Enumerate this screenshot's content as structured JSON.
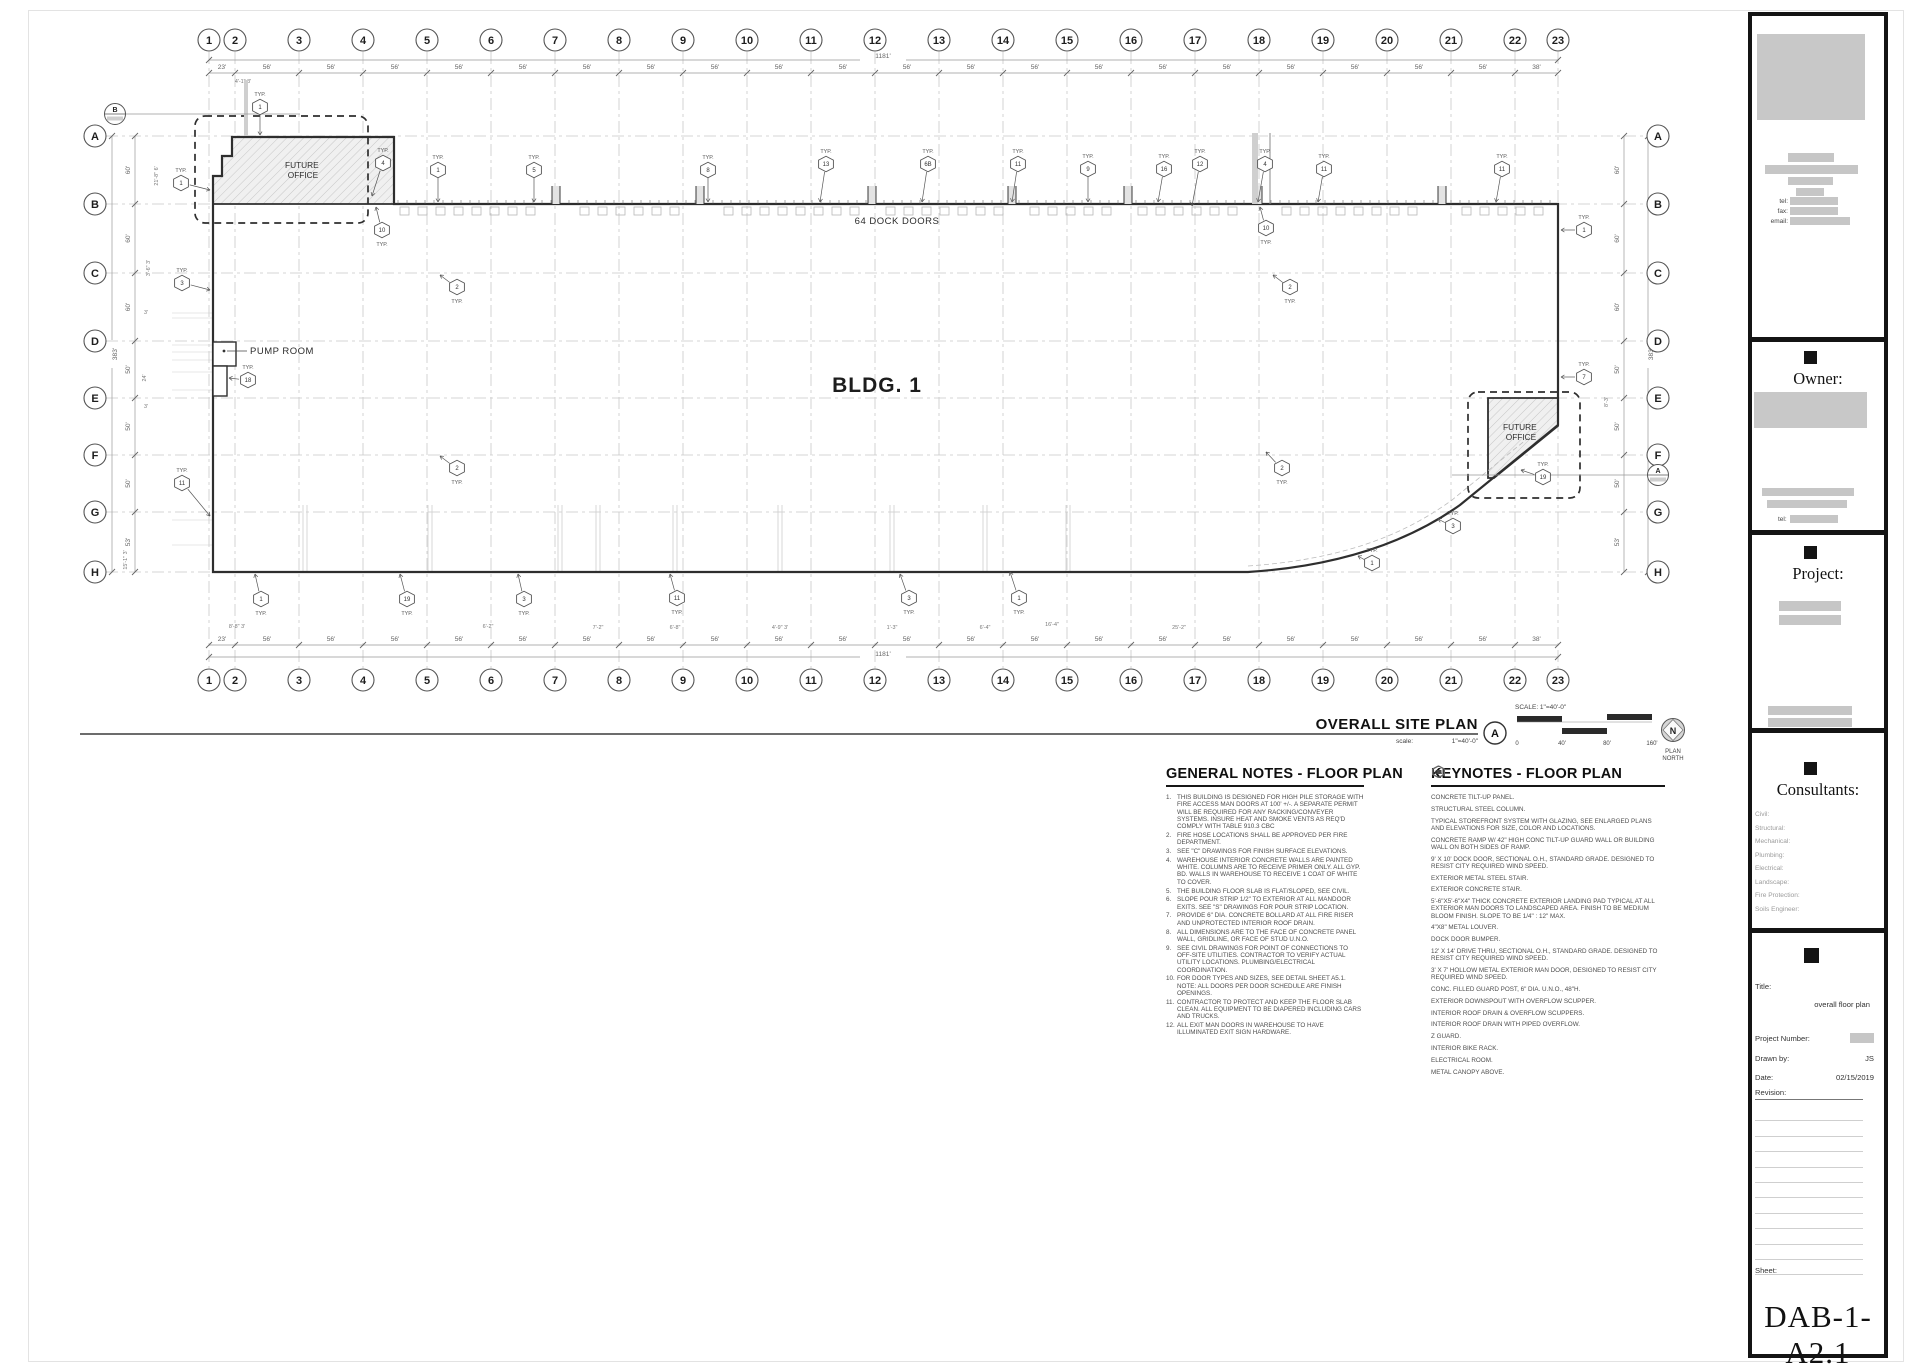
{
  "colors": {
    "wall": "#2e2e2e",
    "centerline": "#c9c9c9",
    "dim": "#999999",
    "redact": "#c6c6c6"
  },
  "plan": {
    "building_label": "BLDG. 1",
    "dock_label": "64 DOCK DOORS",
    "pump_label": "PUMP ROOM",
    "future_office_line1": "FUTURE",
    "future_office_line2": "OFFICE",
    "grid_cols": [
      "1",
      "2",
      "3",
      "4",
      "5",
      "6",
      "7",
      "8",
      "9",
      "10",
      "11",
      "12",
      "13",
      "14",
      "15",
      "16",
      "17",
      "18",
      "19",
      "20",
      "21",
      "22",
      "23"
    ],
    "grid_rows": [
      "A",
      "B",
      "C",
      "D",
      "E",
      "F",
      "G",
      "H"
    ],
    "bay_dims": [
      "23'",
      "56'",
      "56'",
      "56'",
      "56'",
      "56'",
      "56'",
      "56'",
      "56'",
      "56'",
      "56'",
      "56'",
      "56'",
      "56'",
      "56'",
      "56'",
      "56'",
      "56'",
      "56'",
      "56'",
      "56'",
      "38'"
    ],
    "overall_dim": "1181'",
    "side_dims": [
      "60'",
      "60'",
      "60'",
      "50'",
      "50'",
      "50'",
      "53'"
    ],
    "overall_side_dim": "383'",
    "typ_label": "TYP.",
    "ref_markers": [
      {
        "letter": "B",
        "x": 115,
        "y": 114,
        "lx": 300
      },
      {
        "letter": "A",
        "x": 1658,
        "y": 475,
        "lx": 1452
      }
    ],
    "small_dims": [
      {
        "t": "4'-1\" 3'",
        "x": 243,
        "y": 83,
        "rot": false
      },
      {
        "t": "21'-8\" 6'",
        "x": 158,
        "y": 176,
        "rot": true
      },
      {
        "t": "3'-6\" 3'",
        "x": 150,
        "y": 268,
        "rot": true
      },
      {
        "t": "3'",
        "x": 146,
        "y": 314,
        "rot": false
      },
      {
        "t": "24'",
        "x": 146,
        "y": 378,
        "rot": true
      },
      {
        "t": "3'",
        "x": 146,
        "y": 408,
        "rot": false
      },
      {
        "t": "15'-1\" 3'",
        "x": 127,
        "y": 560,
        "rot": true
      },
      {
        "t": "8'-3'",
        "x": 1608,
        "y": 402,
        "rot": true
      },
      {
        "t": "8'-8\" 3'",
        "x": 237,
        "y": 628,
        "rot": false
      },
      {
        "t": "6'-2\"",
        "x": 488,
        "y": 628,
        "rot": false
      },
      {
        "t": "7'-2\"",
        "x": 598,
        "y": 629,
        "rot": false
      },
      {
        "t": "6'-8\"",
        "x": 675,
        "y": 629,
        "rot": false
      },
      {
        "t": "4'-9\" 3'",
        "x": 780,
        "y": 629,
        "rot": false
      },
      {
        "t": "1'-3\"",
        "x": 892,
        "y": 629,
        "rot": false
      },
      {
        "t": "6'-4\"",
        "x": 985,
        "y": 629,
        "rot": false
      },
      {
        "t": "16'-4\"",
        "x": 1052,
        "y": 626,
        "rot": false
      },
      {
        "t": "25'-2\"",
        "x": 1179,
        "y": 629,
        "rot": false
      }
    ],
    "tags": [
      {
        "n": "1",
        "x": 438,
        "y": 170,
        "p": "a",
        "tx": 438,
        "ty": 202
      },
      {
        "n": "5",
        "x": 534,
        "y": 170,
        "p": "a",
        "tx": 534,
        "ty": 202
      },
      {
        "n": "8",
        "x": 708,
        "y": 170,
        "p": "a",
        "tx": 708,
        "ty": 202
      },
      {
        "n": "13",
        "x": 826,
        "y": 164,
        "p": "a",
        "tx": 820,
        "ty": 202
      },
      {
        "n": "6B",
        "x": 928,
        "y": 164,
        "p": "a",
        "tx": 922,
        "ty": 202
      },
      {
        "n": "11",
        "x": 1018,
        "y": 164,
        "p": "a",
        "tx": 1012,
        "ty": 202
      },
      {
        "n": "9",
        "x": 1088,
        "y": 169,
        "p": "a",
        "tx": 1088,
        "ty": 202
      },
      {
        "n": "16",
        "x": 1164,
        "y": 169,
        "p": "a",
        "tx": 1158,
        "ty": 202
      },
      {
        "n": "12",
        "x": 1200,
        "y": 164,
        "p": "a",
        "tx": 1192,
        "ty": 206
      },
      {
        "n": "4",
        "x": 1265,
        "y": 164,
        "p": "a",
        "tx": 1258,
        "ty": 202
      },
      {
        "n": "11",
        "x": 1324,
        "y": 169,
        "p": "a",
        "tx": 1318,
        "ty": 202
      },
      {
        "n": "11",
        "x": 1502,
        "y": 169,
        "p": "a",
        "tx": 1496,
        "ty": 202
      },
      {
        "n": "1",
        "x": 260,
        "y": 107,
        "p": "a",
        "tx": 260,
        "ty": 135
      },
      {
        "n": "4",
        "x": 383,
        "y": 163,
        "p": "a",
        "tx": 372,
        "ty": 196
      },
      {
        "n": "1",
        "x": 181,
        "y": 183,
        "p": "a",
        "tx": 210,
        "ty": 190
      },
      {
        "n": "3",
        "x": 182,
        "y": 283,
        "p": "a",
        "tx": 210,
        "ty": 290
      },
      {
        "n": "18",
        "x": 248,
        "y": 380,
        "p": "a",
        "tx": 229,
        "ty": 378
      },
      {
        "n": "11",
        "x": 182,
        "y": 483,
        "p": "a",
        "tx": 210,
        "ty": 516
      },
      {
        "n": "10",
        "x": 382,
        "y": 230,
        "p": "b",
        "tx": 376,
        "ty": 207
      },
      {
        "n": "10",
        "x": 1266,
        "y": 228,
        "p": "b",
        "tx": 1260,
        "ty": 207
      },
      {
        "n": "2",
        "x": 457,
        "y": 287,
        "p": "b",
        "tx": 440,
        "ty": 275
      },
      {
        "n": "2",
        "x": 1290,
        "y": 287,
        "p": "b",
        "tx": 1273,
        "ty": 275
      },
      {
        "n": "2",
        "x": 457,
        "y": 468,
        "p": "b",
        "tx": 440,
        "ty": 456
      },
      {
        "n": "2",
        "x": 1282,
        "y": 468,
        "p": "b",
        "tx": 1266,
        "ty": 452
      },
      {
        "n": "1",
        "x": 1584,
        "y": 230,
        "p": "a",
        "tx": 1561,
        "ty": 230
      },
      {
        "n": "7",
        "x": 1584,
        "y": 377,
        "p": "a",
        "tx": 1561,
        "ty": 377
      },
      {
        "n": "1",
        "x": 261,
        "y": 599,
        "p": "b",
        "tx": 255,
        "ty": 574
      },
      {
        "n": "19",
        "x": 407,
        "y": 599,
        "p": "b",
        "tx": 400,
        "ty": 574
      },
      {
        "n": "3",
        "x": 524,
        "y": 599,
        "p": "b",
        "tx": 518,
        "ty": 574
      },
      {
        "n": "11",
        "x": 677,
        "y": 598,
        "p": "b",
        "tx": 670,
        "ty": 574
      },
      {
        "n": "3",
        "x": 909,
        "y": 598,
        "p": "b",
        "tx": 900,
        "ty": 574
      },
      {
        "n": "1",
        "x": 1019,
        "y": 598,
        "p": "b",
        "tx": 1010,
        "ty": 572
      },
      {
        "n": "1",
        "x": 1372,
        "y": 563,
        "p": "a",
        "tx": 1358,
        "ty": 556
      },
      {
        "n": "3",
        "x": 1453,
        "y": 526,
        "p": "a",
        "tx": 1438,
        "ty": 519
      },
      {
        "n": "19",
        "x": 1543,
        "y": 477,
        "p": "a",
        "tx": 1521,
        "ty": 470
      }
    ]
  },
  "view_title": {
    "label": "OVERALL SITE PLAN",
    "scale_label": "scale:",
    "scale_value": "1\"=40'-0\"",
    "bubble": "A",
    "scalebar_label": "SCALE: 1\"=40'-0\"",
    "scalebar_ticks": [
      "0",
      "40'",
      "80'",
      "160'"
    ],
    "north_letter": "N",
    "north_caption_line1": "PLAN",
    "north_caption_line2": "NORTH"
  },
  "general_notes": {
    "title": "GENERAL NOTES - FLOOR PLAN",
    "items": [
      "THIS BUILDING IS DESIGNED FOR HIGH PILE STORAGE WITH FIRE ACCESS MAN DOORS AT 100' +/-. A SEPARATE PERMIT WILL BE REQUIRED FOR ANY RACKING/CONVEYER SYSTEMS. INSURE HEAT AND SMOKE VENTS AS REQ'D COMPLY WITH TABLE 910.3 CBC",
      "FIRE HOSE LOCATIONS SHALL BE APPROVED PER FIRE DEPARTMENT.",
      "SEE \"C\" DRAWINGS FOR FINISH SURFACE ELEVATIONS.",
      "WAREHOUSE INTERIOR CONCRETE WALLS ARE PAINTED WHITE. COLUMNS ARE TO RECEIVE PRIMER ONLY. ALL GYP. BD. WALLS IN WAREHOUSE TO RECEIVE 1 COAT OF WHITE TO COVER.",
      "THE BUILDING FLOOR SLAB IS FLAT/SLOPED, SEE CIVIL.",
      "SLOPE POUR STRIP 1/2\" TO EXTERIOR AT ALL MANDOOR EXITS. SEE \"S\" DRAWINGS FOR POUR STRIP LOCATION.",
      "PROVIDE 6\" DIA. CONCRETE BOLLARD AT ALL FIRE RISER AND UNPROTECTED INTERIOR ROOF DRAIN.",
      "ALL DIMENSIONS ARE TO THE FACE OF CONCRETE PANEL WALL, GRIDLINE, OR FACE OF STUD U.N.O.",
      "SEE CIVIL DRAWINGS FOR POINT OF CONNECTIONS TO OFF-SITE UTILITIES. CONTRACTOR TO VERIFY ACTUAL UTILITY LOCATIONS. PLUMBING/ELECTRICAL COORDINATION.",
      "FOR DOOR TYPES AND SIZES, SEE DETAIL SHEET A5.1. NOTE: ALL DOORS PER DOOR SCHEDULE ARE FINISH OPENINGS.",
      "CONTRACTOR TO PROTECT AND KEEP THE FLOOR SLAB CLEAN. ALL EQUIPMENT TO BE DIAPERED INCLUDING CARS AND TRUCKS.",
      "ALL EXIT MAN DOORS IN WAREHOUSE TO HAVE ILLUMINATED EXIT SIGN HARDWARE."
    ]
  },
  "keynotes": {
    "title": "KEYNOTES - FLOOR PLAN",
    "items": [
      {
        "n": "1",
        "text": "CONCRETE TILT-UP PANEL."
      },
      {
        "n": "2",
        "text": "STRUCTURAL STEEL COLUMN."
      },
      {
        "n": "3",
        "text": "TYPICAL STOREFRONT SYSTEM WITH GLAZING, SEE ENLARGED PLANS AND ELEVATIONS FOR SIZE, COLOR AND LOCATIONS."
      },
      {
        "n": "4",
        "text": "CONCRETE RAMP W/ 42\" HIGH CONC TILT-UP GUARD WALL OR BUILDING WALL ON BOTH SIDES OF RAMP."
      },
      {
        "n": "5",
        "text": "9' X 10' DOCK DOOR, SECTIONAL O.H., STANDARD GRADE. DESIGNED TO RESIST CITY REQUIRED WIND SPEED."
      },
      {
        "n": "6A",
        "text": "EXTERIOR METAL STEEL STAIR."
      },
      {
        "n": "6B",
        "text": "EXTERIOR CONCRETE STAIR."
      },
      {
        "n": "7",
        "text": "5'-6\"X5'-6\"X4\" THICK CONCRETE EXTERIOR LANDING PAD TYPICAL AT ALL EXTERIOR MAN DOORS TO LANDSCAPED AREA. FINISH TO BE MEDIUM BLOOM FINISH. SLOPE TO BE 1/4\" : 12\" MAX."
      },
      {
        "n": "8",
        "text": "4\"X8\" METAL LOUVER."
      },
      {
        "n": "9",
        "text": "DOCK DOOR BUMPER."
      },
      {
        "n": "10",
        "text": "12' X 14' DRIVE THRU, SECTIONAL O.H., STANDARD GRADE. DESIGNED TO RESIST CITY REQUIRED WIND SPEED."
      },
      {
        "n": "11",
        "text": "3' X 7' HOLLOW METAL EXTERIOR MAN DOOR, DESIGNED TO RESIST CITY REQUIRED WIND SPEED."
      },
      {
        "n": "12",
        "text": "CONC. FILLED GUARD POST, 6\" DIA. U.N.O., 48\"H."
      },
      {
        "n": "13",
        "text": "EXTERIOR DOWNSPOUT WITH OVERFLOW SCUPPER."
      },
      {
        "n": "14",
        "text": "INTERIOR ROOF DRAIN & OVERFLOW SCUPPERS."
      },
      {
        "n": "15",
        "text": "INTERIOR ROOF DRAIN WITH PIPED OVERFLOW."
      },
      {
        "n": "16",
        "text": "Z GUARD."
      },
      {
        "n": "17",
        "text": "INTERIOR BIKE RACK."
      },
      {
        "n": "18",
        "text": "ELECTRICAL ROOM."
      },
      {
        "n": "19",
        "text": "METAL CANOPY ABOVE."
      }
    ]
  },
  "titleblock": {
    "contact": {
      "tel_label": "tel:",
      "fax_label": "fax:",
      "email_label": "email:"
    },
    "owner": {
      "heading": "Owner:",
      "tel_label": "tel:"
    },
    "project": {
      "heading": "Project:"
    },
    "consultants": {
      "heading": "Consultants:",
      "labels": [
        "Civil:",
        "Structural:",
        "Mechanical:",
        "Plumbing:",
        "Electrical:",
        "Landscape:",
        "Fire Protection:",
        "Soils Engineer:"
      ]
    },
    "info": {
      "title_label": "Title:",
      "title_value": "overall floor plan",
      "project_number_label": "Project Number:",
      "drawn_by_label": "Drawn by:",
      "drawn_by_value": "JS",
      "date_label": "Date:",
      "date_value": "02/15/2019",
      "revision_label": "Revision:",
      "sheet_label": "Sheet:",
      "sheet_value": "DAB-1-A2.1"
    }
  }
}
